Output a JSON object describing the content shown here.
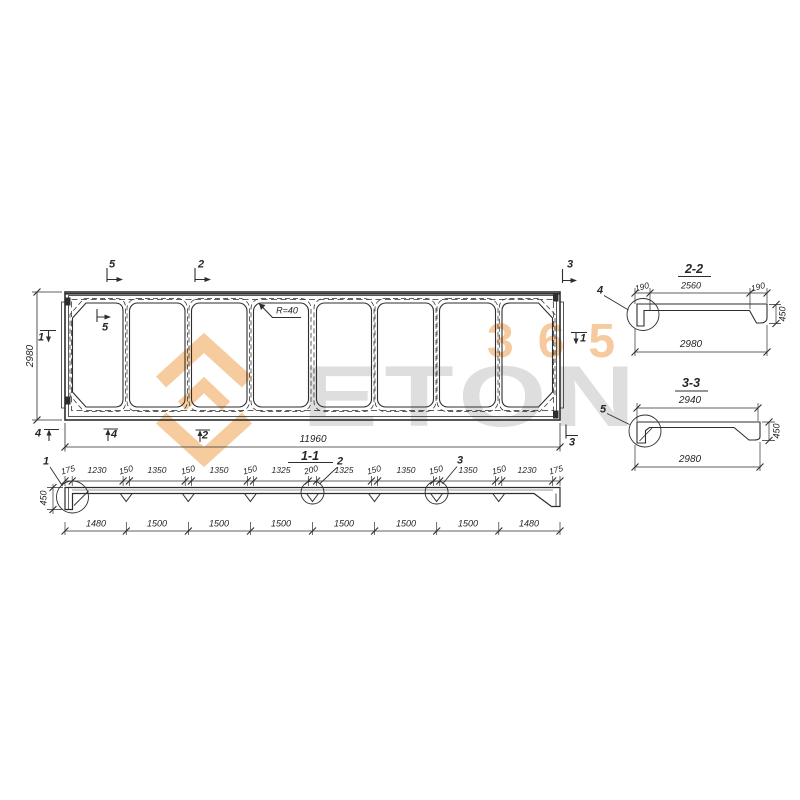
{
  "watermark": {
    "text": "ETON",
    "number": "365",
    "accent_color": "#ef9440",
    "gray_color": "#dedede"
  },
  "plan": {
    "dim_width": "11960",
    "dim_height": "2980",
    "radius_note": "R=40",
    "marks": {
      "top5": "5",
      "top2": "2",
      "top3": "3",
      "inner5": "5",
      "left1": "1",
      "right1": "1",
      "bottom4a": "4",
      "bottom4b": "4",
      "bottom2": "2",
      "bottom3": "3"
    }
  },
  "section11": {
    "title": "1-1",
    "height": "450",
    "detail1": "1",
    "detail2": "2",
    "detail3": "3",
    "top_dims": [
      "175",
      "1230",
      "150",
      "1350",
      "150",
      "1350",
      "150",
      "1325",
      "200",
      "1325",
      "150",
      "1350",
      "150",
      "1350",
      "150",
      "1230",
      "175"
    ],
    "bottom_dims": [
      "1480",
      "1500",
      "1500",
      "1500",
      "1500",
      "1500",
      "1500",
      "1480"
    ]
  },
  "section22": {
    "title": "2-2",
    "dim_left": "190",
    "dim_mid": "2560",
    "dim_right": "190",
    "dim_total": "2980",
    "dim_height": "450",
    "detail": "4"
  },
  "section33": {
    "title": "3-3",
    "dim_top": "2940",
    "dim_total": "2980",
    "dim_height": "450",
    "detail": "5"
  }
}
